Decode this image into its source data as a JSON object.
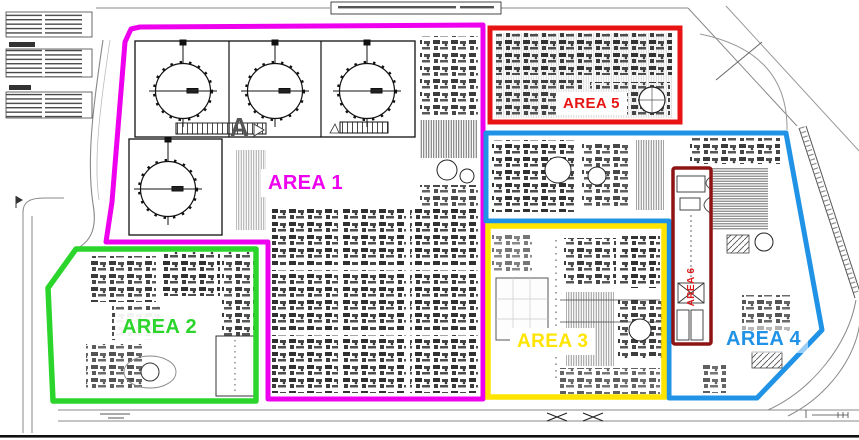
{
  "drawing": {
    "section_marker": "A"
  },
  "areas": [
    {
      "id": "area1",
      "label": "AREA 1",
      "color": "#ee00ee"
    },
    {
      "id": "area2",
      "label": "AREA 2",
      "color": "#2bd52b"
    },
    {
      "id": "area3",
      "label": "AREA 3",
      "color": "#ffe400"
    },
    {
      "id": "area4",
      "label": "AREA 4",
      "color": "#2193e6"
    },
    {
      "id": "area5",
      "label": "AREA 5",
      "color": "#e81414"
    },
    {
      "id": "area6",
      "label": "AREA 6",
      "color": "#8e1414",
      "label_color": "#df1f1f"
    }
  ]
}
